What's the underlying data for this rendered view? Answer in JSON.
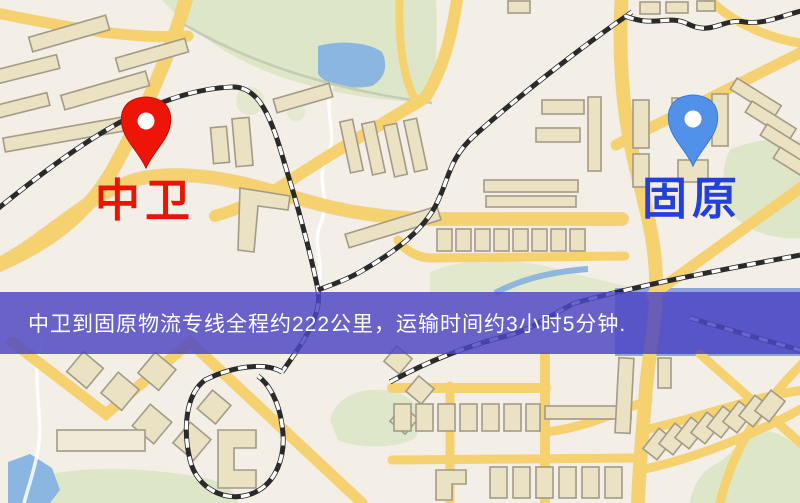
{
  "map": {
    "type": "route-overview-map",
    "origin": {
      "label": "中卫",
      "pin": "red-pin"
    },
    "destination": {
      "label": "固原",
      "pin": "blue-pin"
    },
    "banner": {
      "text": "中卫到固原物流专线全程约222公里，运输时间约3小时5分钟.",
      "distance_km": 222,
      "duration": "3小时5分钟"
    }
  },
  "colors": {
    "banner-bg": "rgba(78,70,196,0.84)",
    "label-red": "#e81504",
    "label-blue": "#2440dc",
    "pin-red": "#ee1408",
    "pin-blue": "#5191ea",
    "road-yellow": "#f5d170",
    "road-edge": "#e7bb55",
    "building-fill": "#ebe2c4",
    "building-stroke": "#a39a87",
    "park-green": "#dde6c6",
    "water-blue": "#8cb6e2"
  }
}
